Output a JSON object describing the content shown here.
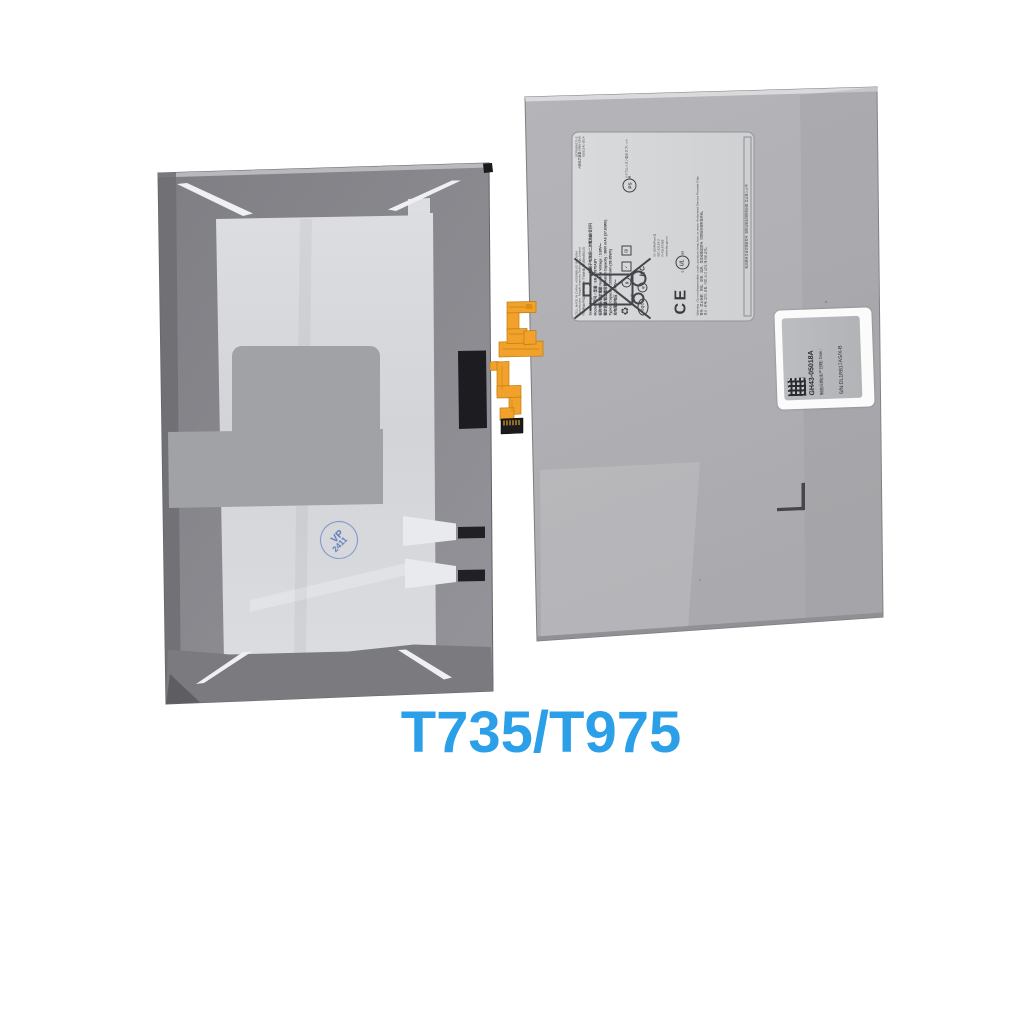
{
  "title": {
    "model_text": "T735/T975",
    "color": "#2b9fe8"
  },
  "stamp": {
    "line1": "VP",
    "line2": "2411"
  },
  "label": {
    "header_lines": [
      "CELL MADE IN CHINA, ASSEMBLED IN CHINA",
      "Manufacturer: Ningde Amperex Technology Limited",
      "中国制造/中国组装 制造商:宁德新能源科技有限公司"
    ],
    "codes": [
      "1ICP5/58/171-2",
      "A级电芯容量:5588-3368",
      "GB31241-2014"
    ],
    "spec_lines": [
      "Secondary Li-ion Battery 锂离子电池组/二次電池組/충전지",
      "Model / 型号 / 型番 : EB-BT975ABY",
      "标称电压/額定電壓 Nominal Voltage : 3.86V⎓",
      "额定容量/額定電容量 Rated Capacity : 9800 mAh (37.83Wh)",
      "Typical Capacity : 10090 mAh (38.95Wh)",
      "充电限制电压 : 4.43V⎓"
    ],
    "certs": {
      "recycle_icon": "♻",
      "li_ion": "Li-ion 00",
      "circ9": "9",
      "ctick": "✓",
      "grid": "⊞",
      "cqc": "CQC",
      "e_mark": "e",
      "kc": "KC",
      "ps_mark": "PS",
      "jp_text": "リチウムイオン電池 タブレット用",
      "is_text": "IS 16046(Part 2)",
      "iec_text": "IEC 62133-2",
      "bis_r": "R-41157359",
      "bis_url": "www.bis.gov.in",
      "ce": "CE",
      "ul_c": "c",
      "ul": "UL",
      "ul_us": "us"
    },
    "warning_en": "Warning : Do not disassemble, crush, puncture, heat, burn or reuse. Authorized Service Provider Only.",
    "warning_cn": "警告 : 禁止拆解、挤压、穿刺、加热、焚烧或重复使用, 仅限授权服务提供商。",
    "warning_kr": "경고 : 분해, 압착, 관통, 가열, 소각 금지, 재사용 금지。",
    "bottom_strip": "电池使用后请勿随意丢弃, 请按当地法规回收处理, 禁止投入火中"
  },
  "sticker": {
    "part_number": "GH43-05018A",
    "date_label": "制造日期(生产日期) Date :",
    "serial": "S/N:DL1R817AS/X-B"
  },
  "colors": {
    "background": "#ffffff",
    "left_battery_frame": "#85858a",
    "left_battery_inner": "#d6d8db",
    "right_battery_body": "#b1b1b5",
    "label_background": "#d4d5d7",
    "flex_cable_orange": "#f2a22b",
    "title_blue": "#2b9fe8",
    "stamp_blue": "#4a6fb8"
  }
}
